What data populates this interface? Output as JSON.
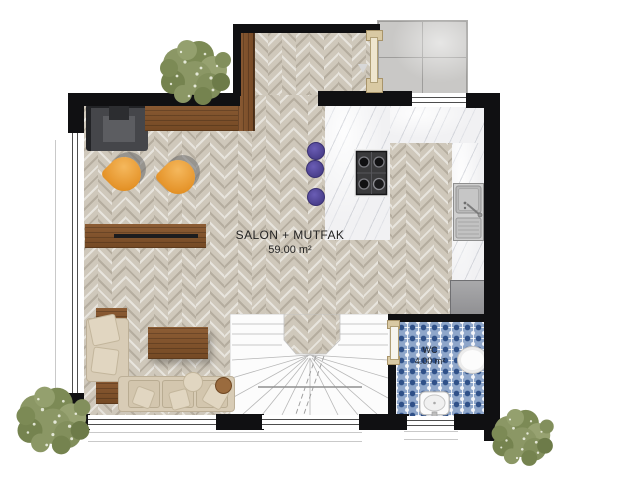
{
  "plan": {
    "type": "floor-plan",
    "language": "Turkish",
    "rooms": [
      {
        "name": "SALON + MUTFAK",
        "area": "59.00 m²"
      },
      {
        "name": "WC",
        "area": "4.00 m²"
      }
    ],
    "fixtures": [
      "stove-4-burner",
      "kitchen-sink",
      "fridge",
      "bar-stools-x3",
      "toilet",
      "wc-sink",
      "u-shaped-stairs",
      "entry-door",
      "wc-door",
      "l-shaped-sofa",
      "coffee-table",
      "tv-sideboard",
      "armchair-dark",
      "tulip-chairs-x2",
      "entry-console",
      "trees-x3",
      "porch-tiles"
    ],
    "colors": {
      "wall": "#101012",
      "floor_herringbone": "#cfc8bb",
      "marble_counter": "#f1f1f3",
      "wc_tile": "#8ea6ca",
      "wood": "#84562f",
      "sofa_beige": "#d8ccb6",
      "chair_orange": "#e6962d",
      "stool_purple": "#4a3f8c",
      "tree_green": "#8b9765"
    }
  }
}
